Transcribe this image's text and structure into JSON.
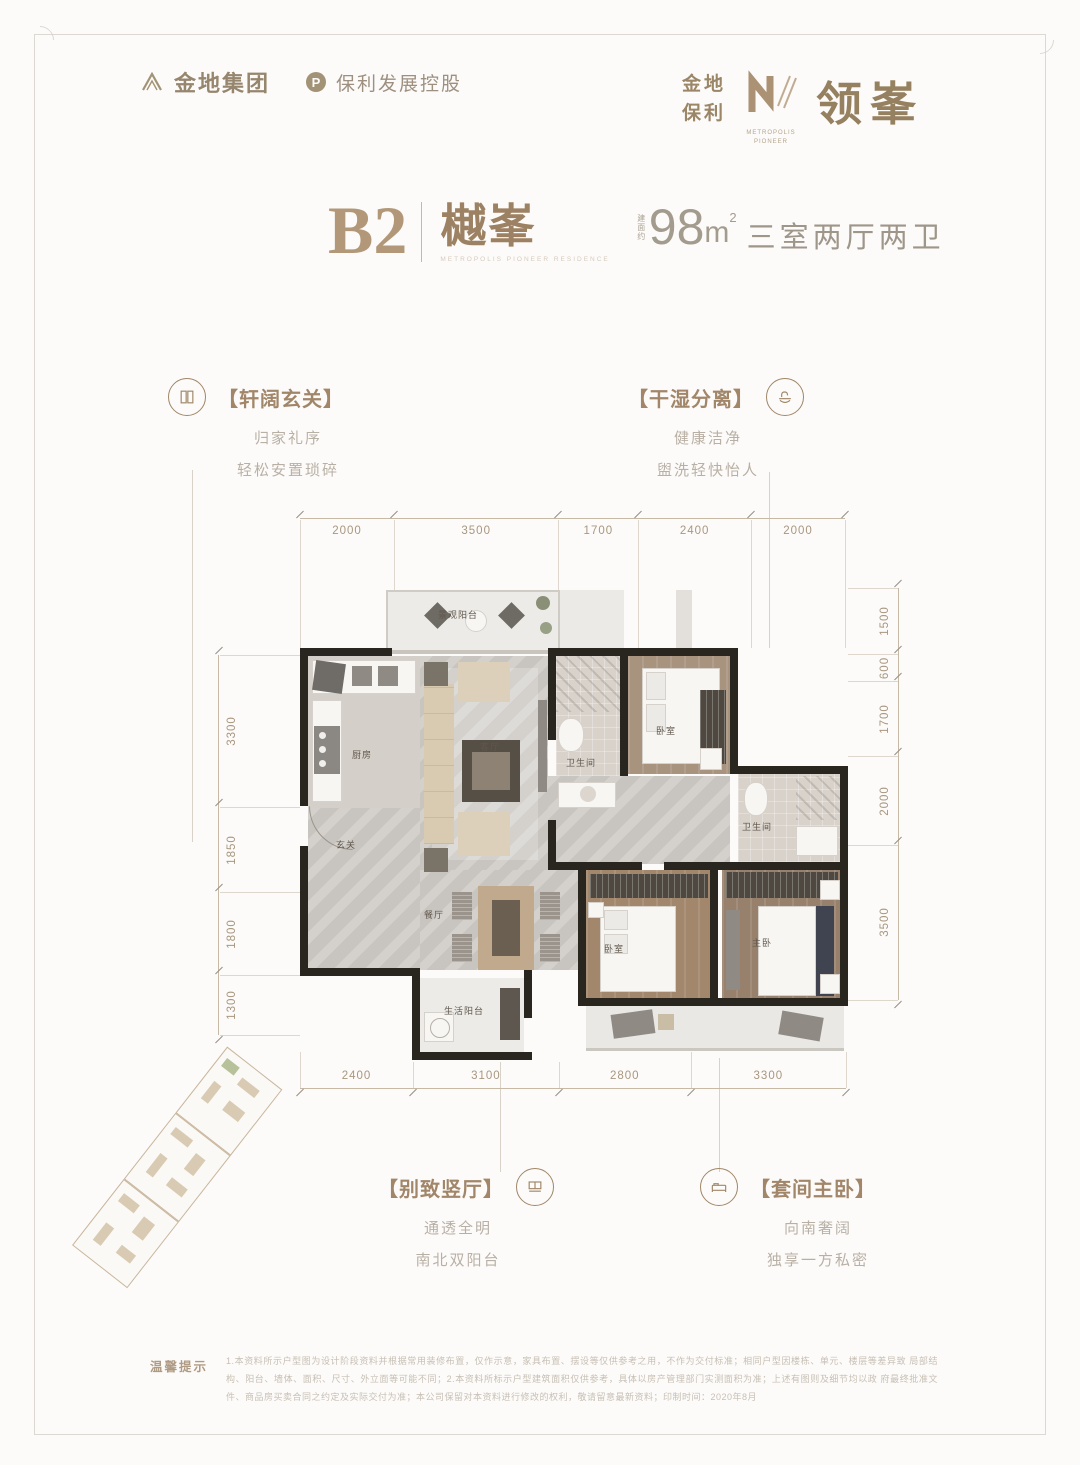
{
  "brand": {
    "gemdale": "金地集团",
    "poly_mark": "P",
    "poly": "保利发展控股"
  },
  "masthead": {
    "jindi": "金地",
    "baoli": "保利",
    "m_word1": "METROPOLIS",
    "m_word2": "PIONEER",
    "name": "领峯"
  },
  "title": {
    "code": "B2",
    "name": "樾峯",
    "name_sub": "METROPOLIS PIONEER RESIDENCE",
    "area_prefix": "建面约",
    "area": "98",
    "area_unit": "m",
    "area_sup": "2",
    "rooms": "三室两厅两卫"
  },
  "callouts": {
    "entry": {
      "title": "【轩阔玄关】",
      "line1": "归家礼序",
      "line2": "轻松安置琐碎"
    },
    "drywet": {
      "title": "【干湿分离】",
      "line1": "健康洁净",
      "line2": "盥洗轻快怡人"
    },
    "hall": {
      "title": "【别致竖厅】",
      "line1": "通透全明",
      "line2": "南北双阳台"
    },
    "master": {
      "title": "【套间主卧】",
      "line1": "向南奢阔",
      "line2": "独享一方私密"
    }
  },
  "dims": {
    "top": [
      "2000",
      "3500",
      "1700",
      "2400",
      "2000"
    ],
    "bottom": [
      "2400",
      "3100",
      "2800",
      "3300"
    ],
    "left": [
      "3300",
      "1850",
      "1800",
      "1300"
    ],
    "right": [
      "1500",
      "600",
      "1700",
      "2000",
      "3500"
    ]
  },
  "plan": {
    "rooms": {
      "north_balcony": "景观阳台",
      "kitchen": "厨房",
      "living": "客厅",
      "foyer": "玄关",
      "dining": "餐厅",
      "bath1": "卫生间",
      "bath2": "卫生间",
      "bedroom_n": "卧室",
      "bedroom_s": "卧室",
      "master": "主卧",
      "life_balcony": "生活阳台"
    }
  },
  "disclaimer": {
    "label": "温馨提示",
    "line1": "1.本资料所示户型图为设计阶段资料并根据常用装修布置，仅作示意，家具布置、摆设等仅供参考之用，不作为交付标准；相同户型因楼栋、单元、楼层等差异致",
    "line2": "局部结构、阳台、墙体、面积、尺寸、外立面等可能不同；2.本资料所标示户型建筑面积仅供参考，具体以房产管理部门实测面积为准；上述有图则及细节均以政",
    "line3": "府最终批准文件、商品房买卖合同之约定及实际交付为准；本公司保留对本资料进行修改的权利，敬请留意最新资料；印制时间：2020年8月"
  }
}
